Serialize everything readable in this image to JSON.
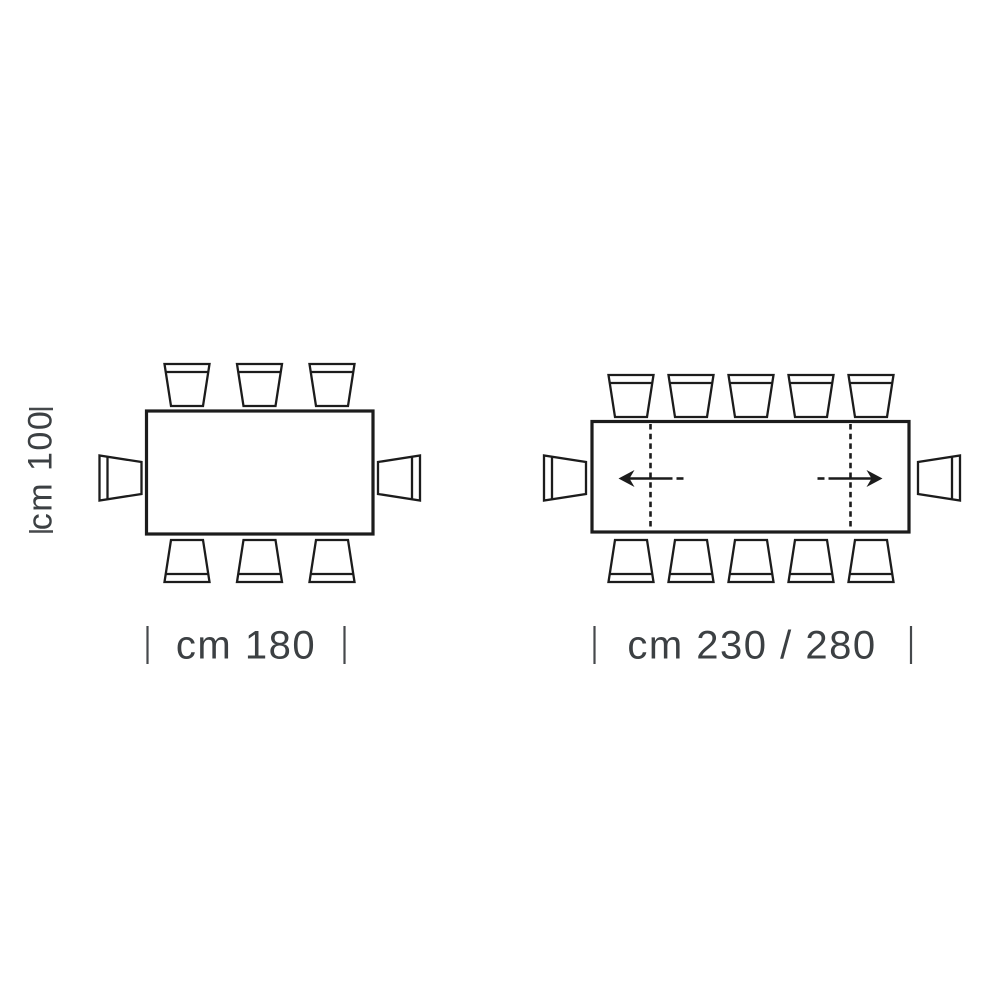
{
  "diagram": {
    "kind": "table-dimensions-top-view",
    "background_color": "#ffffff",
    "line_color": "#1c1c1c",
    "label_color": "#3c4043",
    "fixed_table": {
      "shape": "rectangle",
      "length_label": "cm 180",
      "depth_label": "cm 100",
      "chair_count": 8,
      "chairs": {
        "top": 3,
        "bottom": 3,
        "left": 1,
        "right": 1
      }
    },
    "extendable_table": {
      "shape": "rectangle",
      "length_label": "cm 230 / 280",
      "chair_count": 12,
      "chairs": {
        "top": 5,
        "bottom": 5,
        "left": 1,
        "right": 1
      },
      "extendable": true,
      "leaf_lines": 2,
      "extension_arrows": [
        "left",
        "right"
      ]
    }
  }
}
